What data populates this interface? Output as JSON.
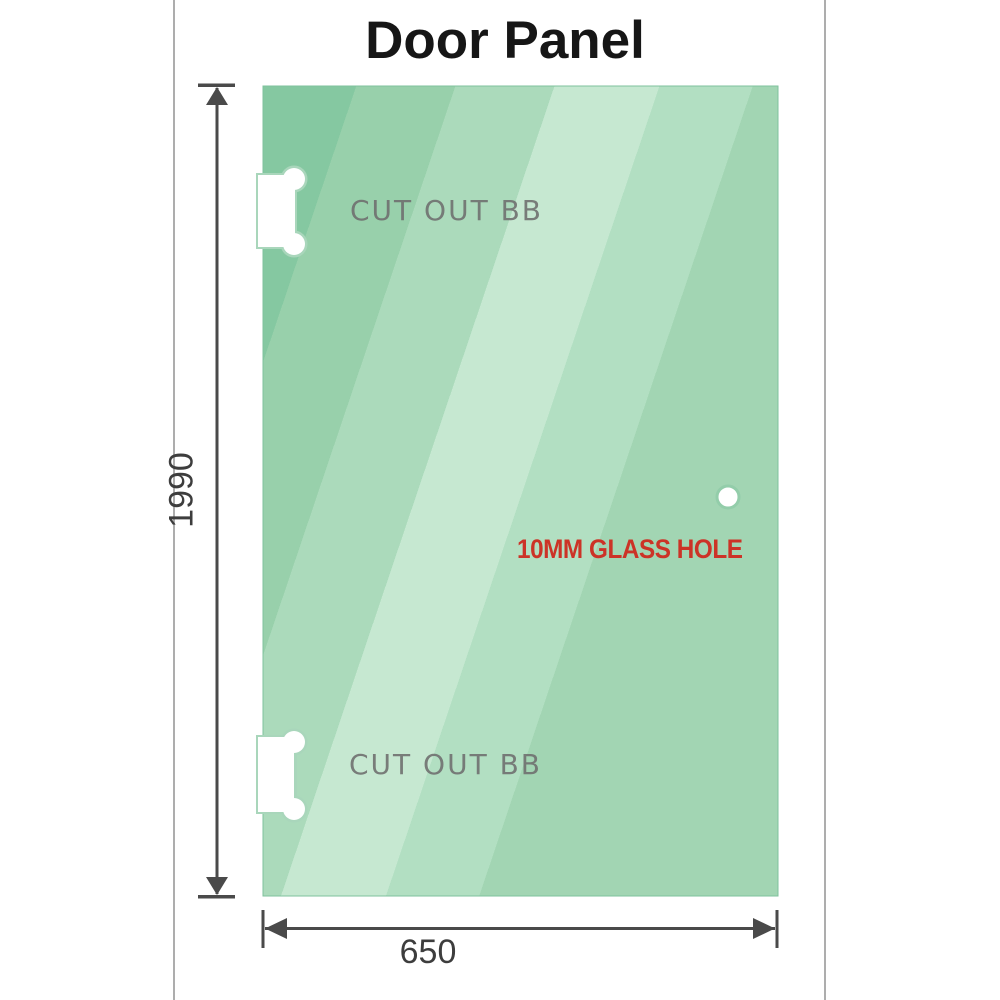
{
  "title": "Door Panel",
  "panel": {
    "cutout_top_label": "CUT OUT BB",
    "cutout_bottom_label": "CUT OUT BB",
    "hole_label": "10MM GLASS HOLE"
  },
  "dimensions": {
    "height": "1990",
    "width": "650"
  },
  "colors": {
    "glass_dark": "#85c8a1",
    "glass_mid": "#98d0ab",
    "glass_light": "#c6e8d1",
    "glass_soft": "#b2dfc2",
    "glass_edge": "#7fc29d",
    "cutout_halo": "#a9d6bb",
    "dimension_line": "#4a4a4a",
    "label_text": "#3d3d3d",
    "cutout_text": "#6e6e6e",
    "hole_text": "#cc3327",
    "title_text": "#161616",
    "frame_line": "#adadad"
  }
}
